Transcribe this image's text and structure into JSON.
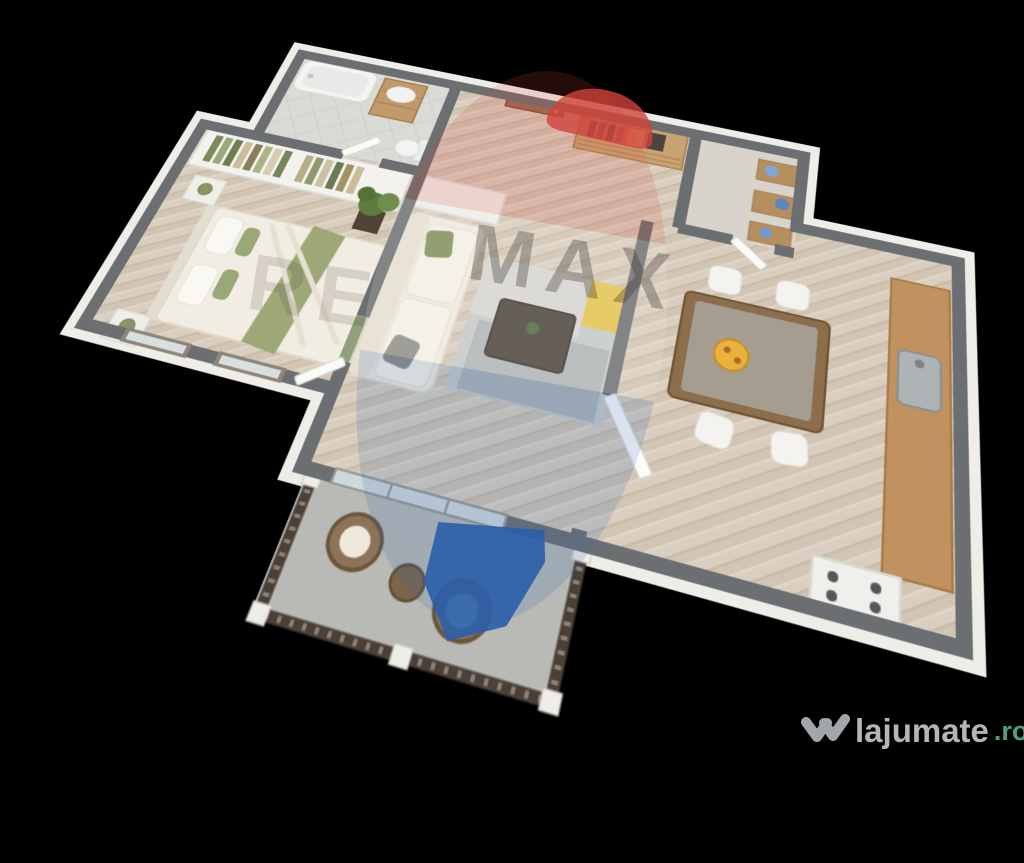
{
  "image": {
    "kind": "3d-floor-plan-render",
    "background_color": "#000000"
  },
  "watermark": {
    "brand": "RE/MAX",
    "left_text": "RE",
    "right_text": "MAX",
    "balloon_colors": {
      "red": "#cf4238",
      "white": "#efece6",
      "blue": "#2b5fa8"
    }
  },
  "logo": {
    "site_text": "lajumate",
    "tld_text": ".ro",
    "text_color": "#b3b6b8",
    "tld_color": "#4d9d8b",
    "icon": "heart-check-icon"
  },
  "palette": {
    "wall_top_gray": "#6c6f72",
    "exterior_wall_white": "#efede8",
    "wood_floor": "#d9cec0",
    "bathroom_tile": "#dadad6",
    "balcony_floor": "#b9bab5",
    "furniture_wood": "#c1925f",
    "olive_green_accent": "#8a9464",
    "rug_gray": "#c6cacb",
    "rug_yellow": "#e5c44d",
    "railing_brown": "#4a4037"
  },
  "floorplan": {
    "rooms": [
      {
        "name": "bathroom",
        "furniture": [
          "bathtub",
          "vanity-sink",
          "toilet"
        ]
      },
      {
        "name": "entry-hall",
        "furniture": [
          "entry-door",
          "rattan-wardrobe"
        ]
      },
      {
        "name": "storage-closet",
        "furniture": [
          "shelves-with-blue-linens"
        ]
      },
      {
        "name": "bedroom",
        "furniture": [
          "open-closet-with-clothes",
          "double-bed",
          "nightstands-with-lamps",
          "potted-plant",
          "two-windows"
        ]
      },
      {
        "name": "living-room",
        "furniture": [
          "white-sofa",
          "coffee-table",
          "area-rug",
          "white-cabinet",
          "sliding-glass-door"
        ]
      },
      {
        "name": "kitchen-dining",
        "furniture": [
          "dining-table",
          "four-white-chairs",
          "plate-of-food",
          "kitchen-counter",
          "sink",
          "stove",
          "open-white-door"
        ]
      },
      {
        "name": "balcony",
        "furniture": [
          "two-wicker-chairs",
          "round-table",
          "railing"
        ]
      }
    ]
  }
}
